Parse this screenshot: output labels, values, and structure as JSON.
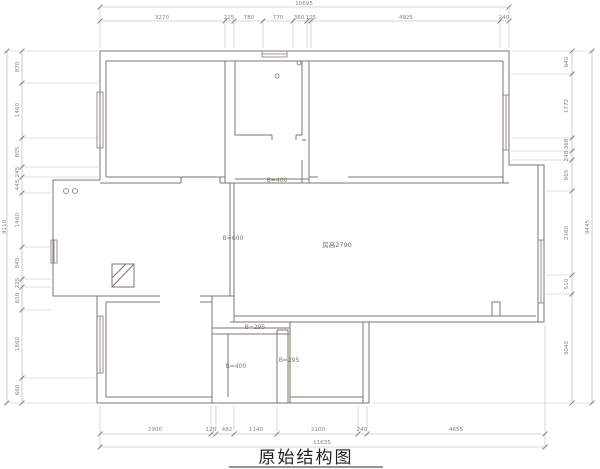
{
  "title": {
    "text": "原始结构图"
  },
  "plan": {
    "room_height_label": "房高2790",
    "beam_hall_label": "B=400",
    "beam_living_label": "B=600",
    "beam_bath_top_label": "B=295",
    "beam_bath_left_label": "B=400",
    "beam_duct_label": "B=295"
  },
  "dims": {
    "top": {
      "total": "10695",
      "segments": [
        "3270",
        "225",
        "780",
        "770",
        "360",
        "125",
        "4925",
        "240"
      ]
    },
    "bottom": {
      "total": "11635",
      "segments": [
        "2900",
        "120",
        "482",
        "1140",
        "2100",
        "240",
        "4655"
      ]
    },
    "left": {
      "total": "9110",
      "segments": [
        "870",
        "1460",
        "805",
        "245",
        "445",
        "1460",
        "845",
        "225",
        "610",
        "1860",
        "660"
      ]
    },
    "right": {
      "total": "9445",
      "segments": [
        "640",
        "1772",
        "368",
        "248",
        "865",
        "2360",
        "510",
        "3040"
      ]
    }
  },
  "colors": {
    "wall": "#7d776f",
    "dimension_line": "#b3ada6",
    "dimension_text": "#8a847c",
    "title_text": "#1f1f1f",
    "background": "#ffffff"
  }
}
